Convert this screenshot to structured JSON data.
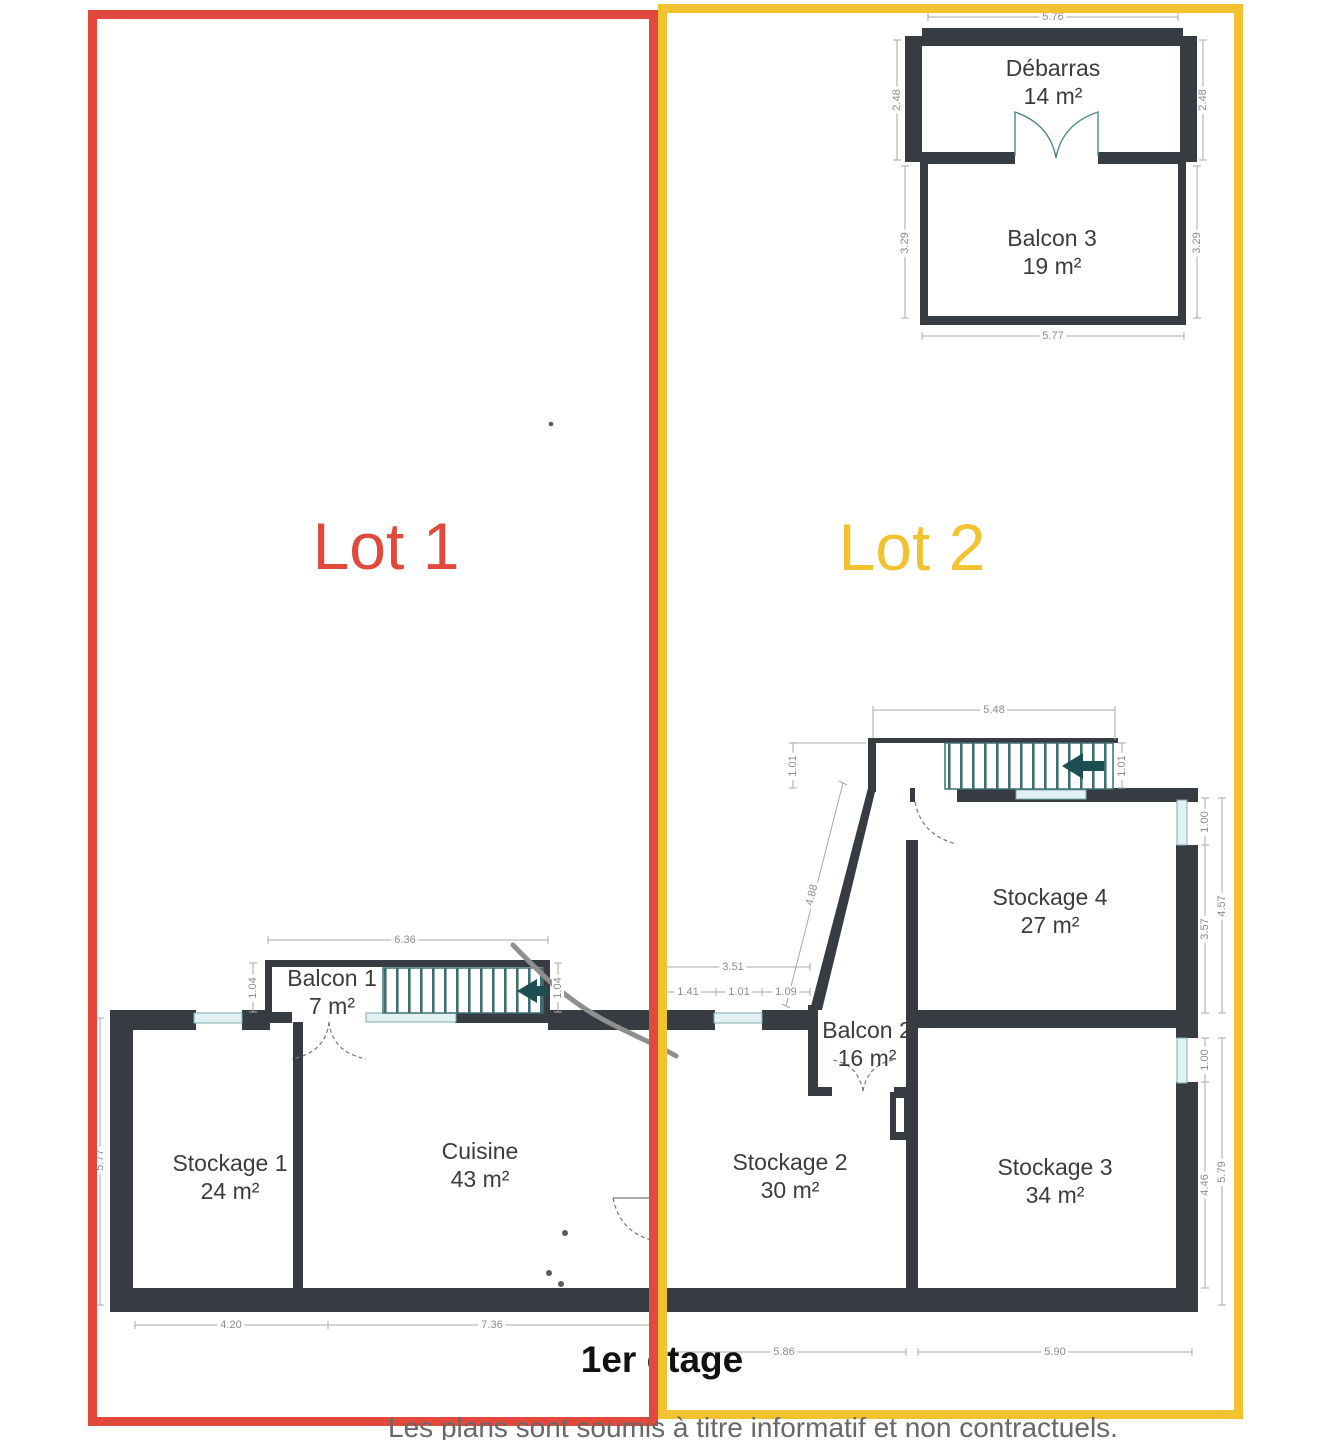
{
  "floor": {
    "title": "1er étage"
  },
  "disclaimer": "Les plans sont soumis à titre informatif et non contractuels.",
  "lots": [
    {
      "label": "Lot 1",
      "color": "#e2493c"
    },
    {
      "label": "Lot 2",
      "color": "#f2c230"
    }
  ],
  "rooms": [
    {
      "name": "Débarras",
      "area": "14 m²"
    },
    {
      "name": "Balcon 3",
      "area": "19 m²"
    },
    {
      "name": "Stockage 4",
      "area": "27 m²"
    },
    {
      "name": "Balcon 1",
      "area": "7 m²"
    },
    {
      "name": "Balcon 2",
      "area": "16 m²"
    },
    {
      "name": "Stockage 1",
      "area": "24 m²"
    },
    {
      "name": "Cuisine",
      "area": "43 m²"
    },
    {
      "name": "Stockage 2",
      "area": "30 m²"
    },
    {
      "name": "Stockage 3",
      "area": "34 m²"
    }
  ],
  "dimensions": {
    "debarras_top": "5.76",
    "debarras_left": "2.48",
    "debarras_right": "2.48",
    "balcon3_left": "3.29",
    "balcon3_right": "3.29",
    "balcon3_bottom": "5.77",
    "stairs_top": "5.48",
    "stairs_left": "1.01",
    "stairs_right": "1.01",
    "diagonal_wall": "4.88",
    "stockage4_window": "1.00",
    "stockage4_wall": "3.57",
    "stockage4_total": "4.57",
    "balcon1_top": "6.36",
    "balcon1_left": "1.04",
    "balcon1_right": "1.04",
    "window_total": "3.51",
    "window_left": "1.41",
    "window_mid": "1.01",
    "window_right": "1.09",
    "plan_left": "5.77",
    "stockage1_bottom": "4.20",
    "cuisine_bottom": "7.36",
    "stockage2_bottom": "5.86",
    "stockage3_bottom": "5.90",
    "stockage3_window": "1.00",
    "stockage3_wall": "4.46",
    "stockage3_total": "5.79"
  },
  "colors": {
    "wall": "#373c43",
    "stairs": "#3f6f72",
    "stair_arrow": "#1d4f52",
    "window_glass": "#e4f1f2",
    "dimension_text": "#8c8c8c",
    "lot1": "#e2493c",
    "lot2": "#f2c230"
  }
}
